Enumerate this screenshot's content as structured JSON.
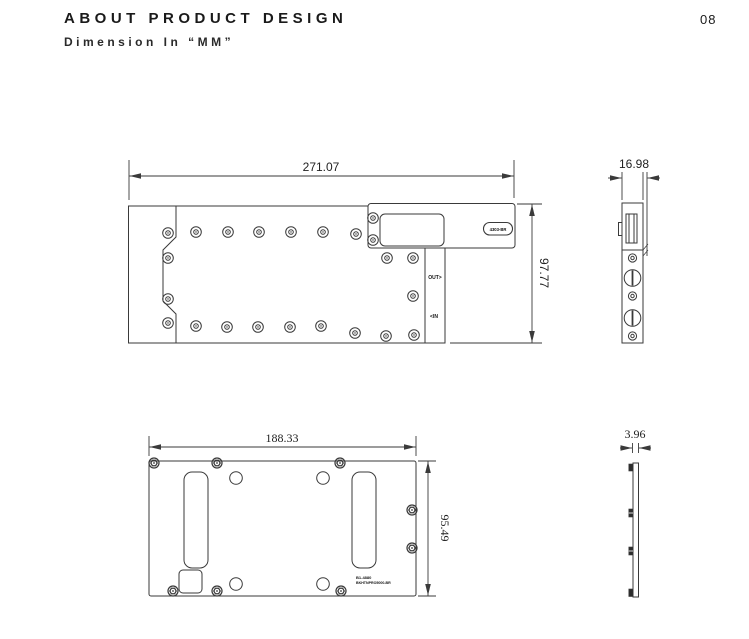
{
  "page": {
    "title": "ABOUT PRODUCT DESIGN",
    "subtitle": "Dimension In “MM”",
    "number": "08"
  },
  "views": {
    "front_top": {
      "width_dim": "271.07",
      "height_dim": "97.77",
      "out_port": "OUT>",
      "in_port": "<IN",
      "tag": "4303-BR"
    },
    "side_top": {
      "thickness_dim": "16.98"
    },
    "front_bottom": {
      "width_dim": "188.33",
      "height_dim": "95.49",
      "code_line1": "B1-4880",
      "code_line2": "BKHTNPRO5000-BR"
    },
    "side_bottom": {
      "thickness_dim": "3.96"
    }
  },
  "colors": {
    "line": "#3a3a3a",
    "text": "#222222"
  }
}
